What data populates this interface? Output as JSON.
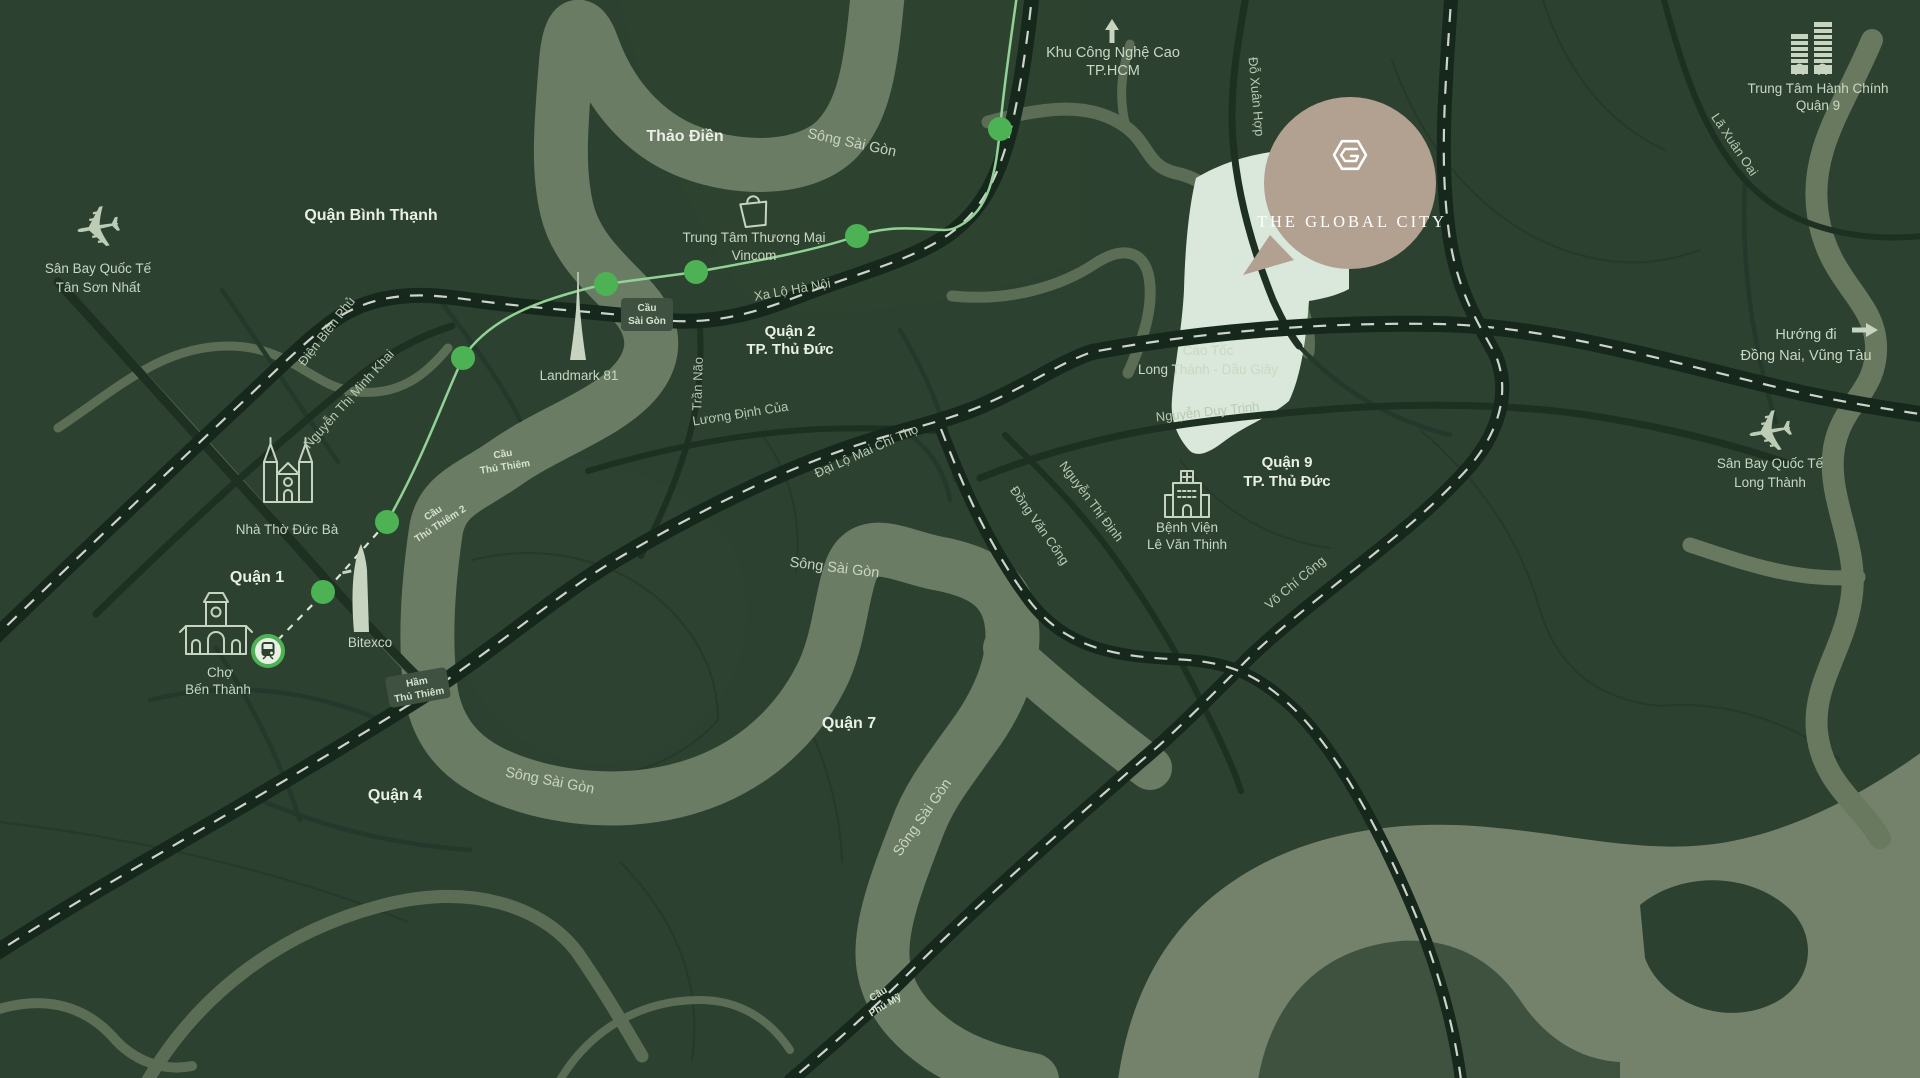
{
  "map": {
    "project": {
      "name": "THE GLOBAL CITY"
    },
    "districts": {
      "binh_thanh": "Quận Bình Thạnh",
      "thao_dien": "Thảo Điền",
      "quan_1": "Quận 1",
      "quan_4": "Quận 4",
      "quan_7": "Quận 7",
      "quan_2_line1": "Quận 2",
      "quan_2_line2": "TP. Thủ Đức",
      "quan_9_line1": "Quận 9",
      "quan_9_line2": "TP. Thủ Đức"
    },
    "river_label": "Sông Sài Gòn",
    "roads": {
      "xa_lo_ha_noi": "Xa Lộ Hà Nội",
      "dien_bien_phu": "Điện Biên Phủ",
      "nguyen_thi_minh_khai": "Nguyễn Thị Minh Khai",
      "tran_nao": "Trần Não",
      "luong_dinh_cua": "Lương Định Của",
      "dai_lo_mai_chi_tho": "Đại Lộ Mai Chí Thọ",
      "dong_van_cong": "Đồng Văn Cống",
      "nguyen_thi_dinh": "Nguyễn Thị Định",
      "vo_chi_cong": "Võ Chí Công",
      "nguyen_duy_trinh": "Nguyễn Duy Trinh",
      "do_xuan_hop": "Đỗ Xuân Hợp",
      "la_xuan_oai": "Lã Xuân Oai",
      "cao_toc_line1": "Cao Tốc",
      "cao_toc_line2": "Long Thành - Dầu Giây"
    },
    "bridges": {
      "cau_sai_gon": [
        "Cầu",
        "Sài Gòn"
      ],
      "cau_thu_thiem": [
        "Cầu",
        "Thủ Thiêm"
      ],
      "cau_thu_thiem_2": [
        "Cầu",
        "Thủ Thiêm 2"
      ],
      "ham_thu_thiem": [
        "Hầm",
        "Thủ Thiêm"
      ],
      "cau_phu_my": [
        "Cầu",
        "Phú Mỹ"
      ]
    },
    "pois": {
      "tsn_airport": [
        "Sân Bay Quốc Tế",
        "Tân Sơn Nhất"
      ],
      "lt_airport": [
        "Sân Bay Quốc Tế",
        "Long Thành"
      ],
      "vincom": [
        "Trung Tâm Thương Mại",
        "Vincom"
      ],
      "landmark": "Landmark 81",
      "cathedral": "Nhà Thờ Đức Bà",
      "ben_thanh": [
        "Chợ",
        "Bến Thành"
      ],
      "bitexco": "Bitexco",
      "hospital": [
        "Bệnh Viện",
        "Lê Văn Thịnh"
      ],
      "admin_center": [
        "Trung Tâm Hành Chính",
        "Quận 9"
      ],
      "hi_tech_park": [
        "Khu Công Nghệ Cao",
        "TP.HCM"
      ],
      "direction_dong_nai": [
        "Hướng đi",
        "Đồng Nai, Vũng Tàu"
      ]
    },
    "colors": {
      "background": "#2c4130",
      "river": "#6b7c64",
      "road_dark": "#16271b",
      "metro_green": "#4cb254",
      "site_mint": "#d9e8da",
      "logo_circle": "#b2a091",
      "label_light": "#c9d7c3",
      "label_white": "#e9efe5"
    }
  }
}
